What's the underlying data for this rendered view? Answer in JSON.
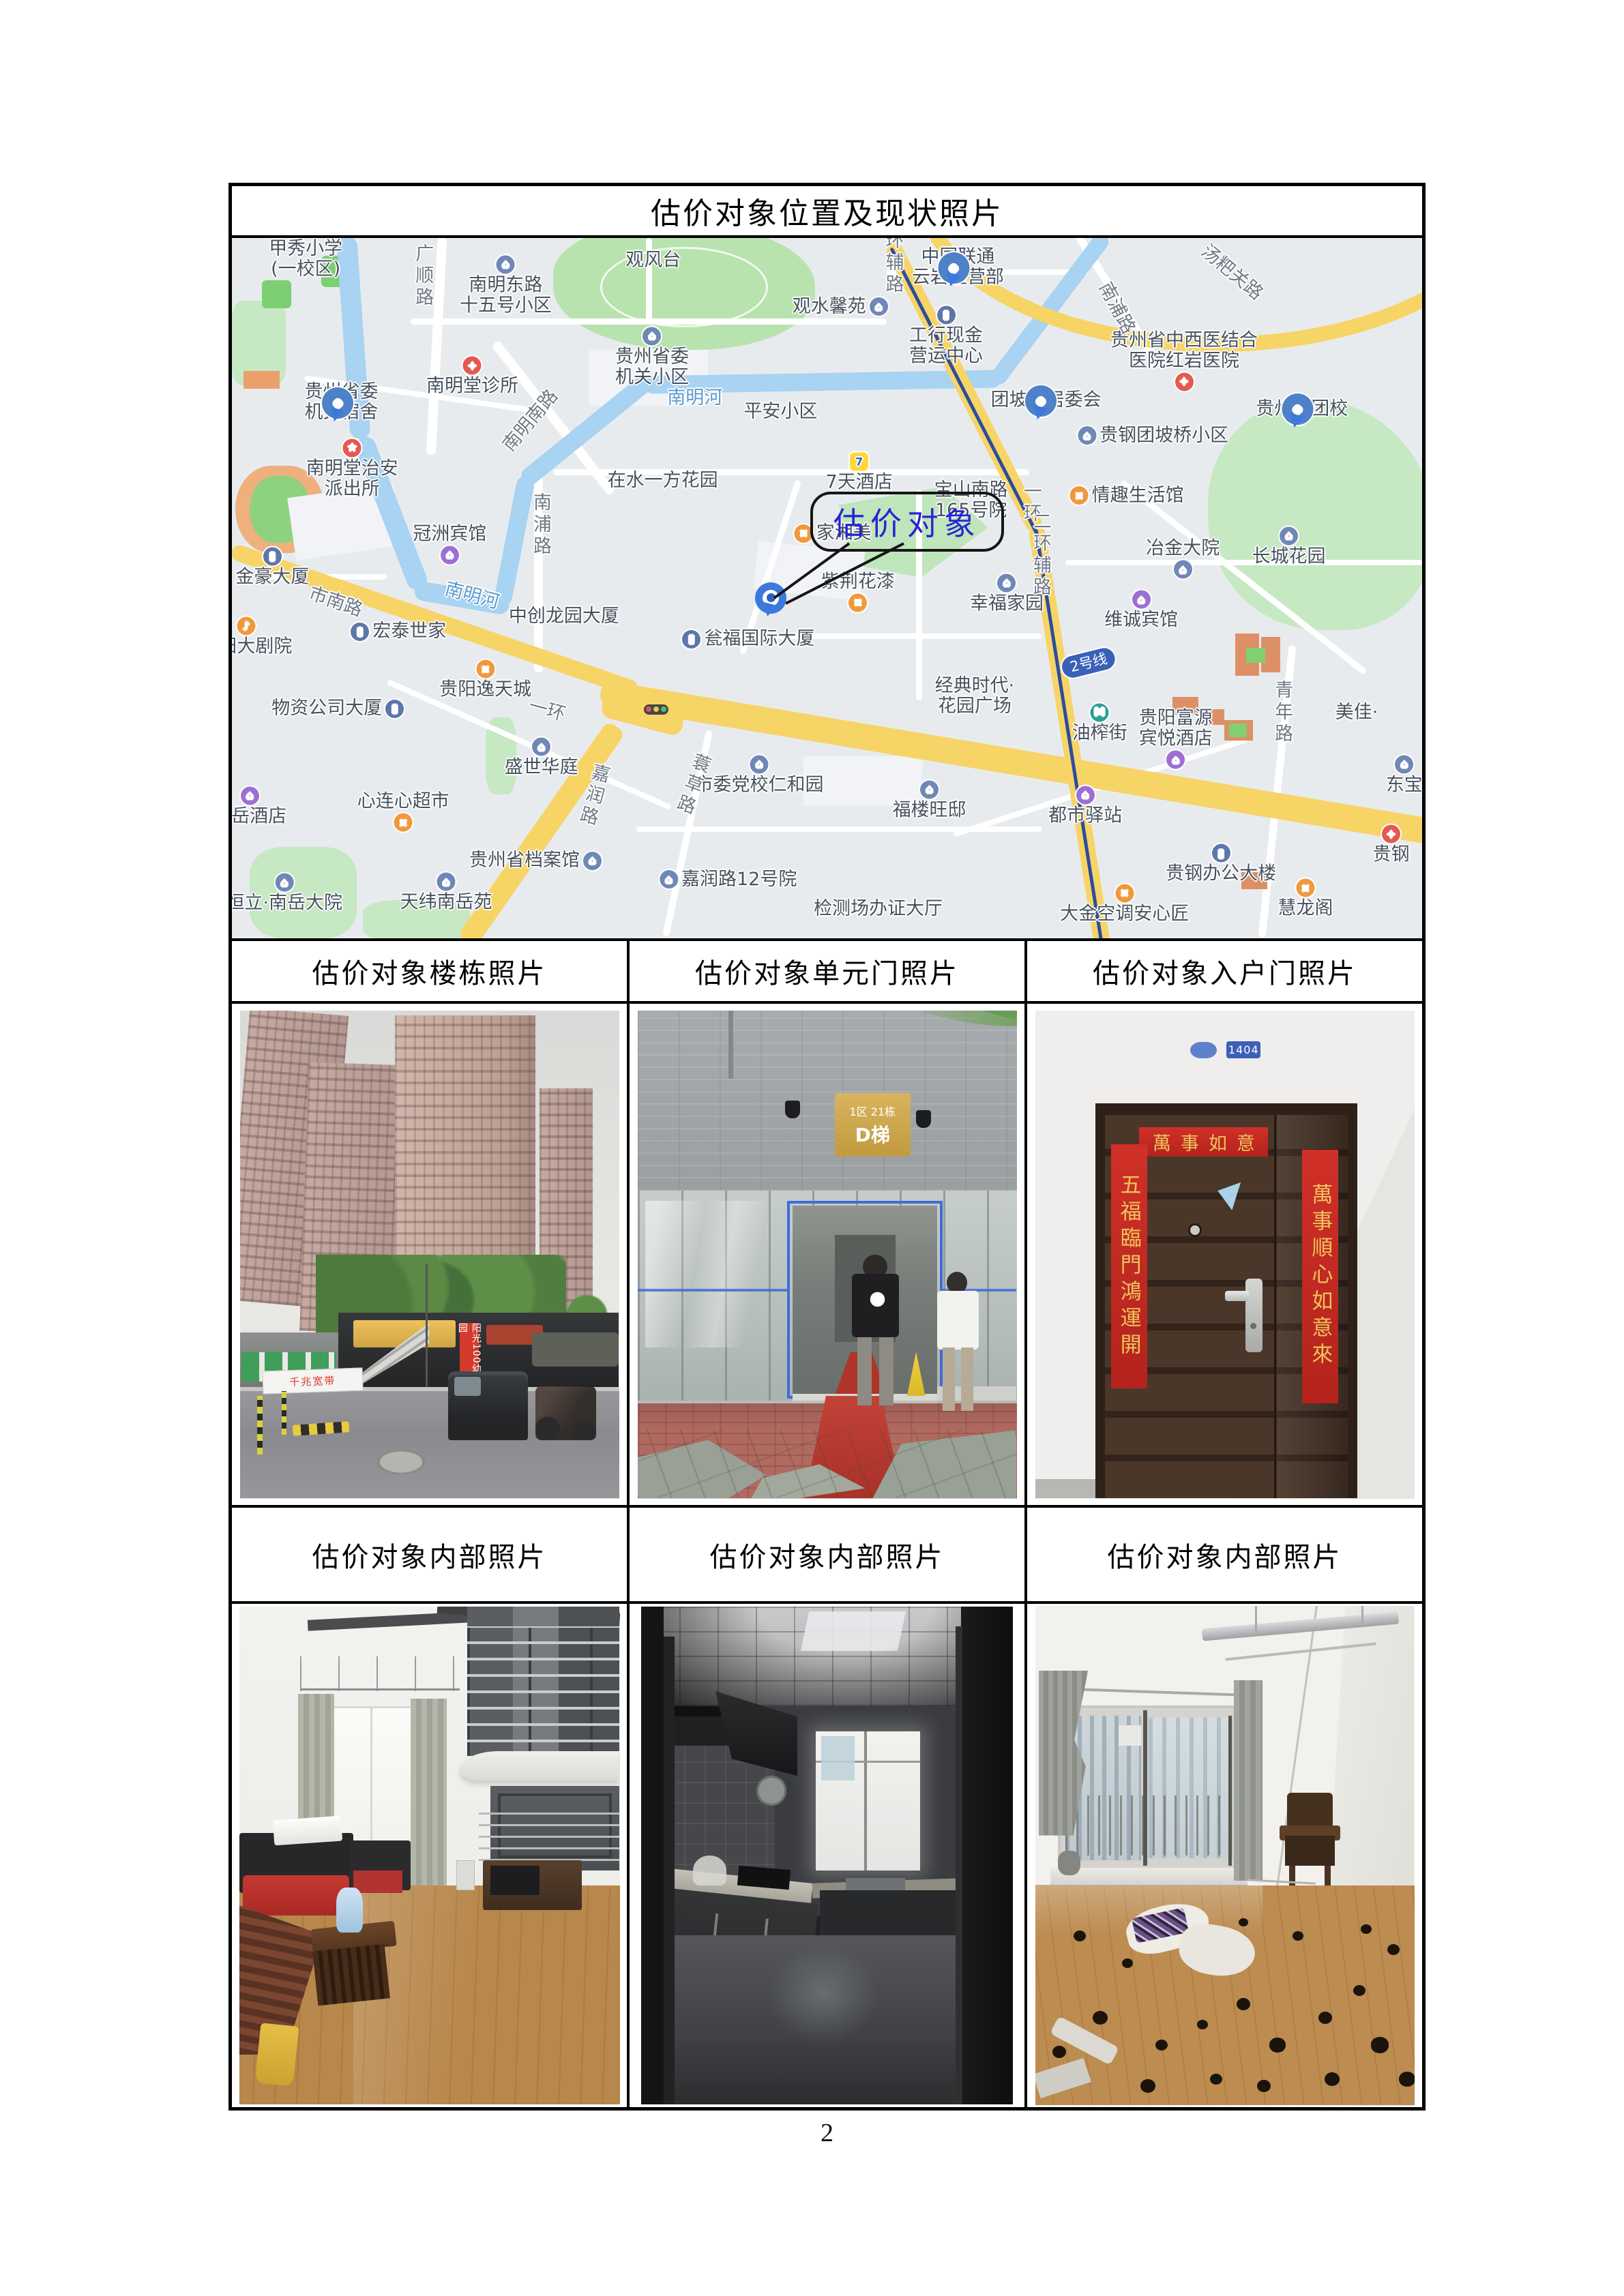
{
  "page": {
    "number": "2"
  },
  "table": {
    "title": "估价对象位置及现状照片",
    "row2_headers": [
      "估价对象楼栋照片",
      "估价对象单元门照片",
      "估价对象入户门照片"
    ],
    "row3_headers": [
      "估价对象内部照片",
      "估价对象内部照片",
      "估价对象内部照片"
    ]
  },
  "map": {
    "callout": {
      "label": "估价对象"
    },
    "labels": [
      {
        "t": "甲秀小学|(一校区)",
        "x": 6.2,
        "y": 3.0
      },
      {
        "t": "广顺路",
        "x": 16.0,
        "y": 5.5,
        "cls": "road",
        "vert": 1
      },
      {
        "t": "南明东路|十五号小区",
        "x": 23.0,
        "y": 6.8,
        "icon": "home",
        "ipos": "above"
      },
      {
        "t": "观风台",
        "x": 35.4,
        "y": 3.2
      },
      {
        "t": "观水馨苑",
        "x": 51.1,
        "y": 9.8,
        "icon": "home",
        "ipos": "right"
      },
      {
        "t": "中国联通|云岩经营部",
        "x": 61.0,
        "y": 4.2,
        "icon": "pin",
        "ipos": "left"
      },
      {
        "t": "工行现金|营运中心",
        "x": 60.0,
        "y": 14.0,
        "icon": "building",
        "ipos": "above"
      },
      {
        "t": "贵州省中西医结合|医院红岩医院",
        "x": 80.0,
        "y": 17.5,
        "icon": "hospital",
        "ipos": "below"
      },
      {
        "t": "汤粑关路",
        "x": 84.0,
        "y": 5.0,
        "cls": "road",
        "rot": 40
      },
      {
        "t": "南浦路",
        "x": 74.3,
        "y": 10.0,
        "cls": "road",
        "rot": 62
      },
      {
        "t": "贵州省委|机关宿舍",
        "x": 9.2,
        "y": 23.5,
        "icon": "pin",
        "ipos": "right"
      },
      {
        "t": "南明堂诊所",
        "x": 20.2,
        "y": 19.8,
        "icon": "hospital",
        "ipos": "above"
      },
      {
        "t": "贵州省委|机关小区",
        "x": 35.3,
        "y": 17.0,
        "icon": "home",
        "ipos": "above"
      },
      {
        "t": "南明堂治安|派出所",
        "x": 10.1,
        "y": 33.0,
        "icon": "police",
        "ipos": "above"
      },
      {
        "t": "南明南路",
        "x": 25.1,
        "y": 26.1,
        "cls": "road",
        "rot": -50
      },
      {
        "t": "南明河",
        "x": 38.9,
        "y": 22.9,
        "cls": "river"
      },
      {
        "t": "平安小区",
        "x": 46.1,
        "y": 24.8
      },
      {
        "t": "在水一方花园",
        "x": 36.2,
        "y": 34.7
      },
      {
        "t": "团坡桥居委会",
        "x": 68.4,
        "y": 23.2,
        "icon": "pin",
        "ipos": "right"
      },
      {
        "t": "贵钢团坡桥小区",
        "x": 77.4,
        "y": 28.2,
        "icon": "home",
        "ipos": "left"
      },
      {
        "t": "贵州省团校",
        "x": 89.9,
        "y": 24.4,
        "icon": "pin",
        "ipos": "above"
      },
      {
        "t": "情趣生活馆",
        "x": 75.2,
        "y": 36.8,
        "icon": "shop",
        "ipos": "left"
      },
      {
        "t": "7天酒店",
        "x": 52.7,
        "y": 33.5,
        "icon": "seven",
        "ipos": "above"
      },
      {
        "t": "宝山南路|165号院",
        "x": 62.1,
        "y": 37.5
      },
      {
        "t": "家湘美",
        "x": 50.5,
        "y": 42.2,
        "icon": "shop",
        "ipos": "left"
      },
      {
        "t": "紫荆花漆",
        "x": 52.6,
        "y": 50.5,
        "icon": "shop",
        "ipos": "below"
      },
      {
        "t": "幸福家园",
        "x": 65.1,
        "y": 50.8,
        "icon": "home",
        "ipos": "above"
      },
      {
        "t": "冠洲宾馆",
        "x": 18.3,
        "y": 43.7,
        "icon": "hotel",
        "ipos": "below"
      },
      {
        "t": "南浦路",
        "x": 25.9,
        "y": 41.0,
        "cls": "road",
        "vert": 1
      },
      {
        "t": "金豪大厦",
        "x": 3.4,
        "y": 47.0,
        "icon": "building",
        "ipos": "above"
      },
      {
        "t": "市南路",
        "x": 8.7,
        "y": 52.0,
        "cls": "road",
        "rot": 19
      },
      {
        "t": "贵阳大剧院",
        "x": 1.2,
        "y": 57.0,
        "icon": "music",
        "ipos": "above"
      },
      {
        "t": "宏泰世家",
        "x": 14.0,
        "y": 56.2,
        "icon": "building",
        "ipos": "left"
      },
      {
        "t": "南明河",
        "x": 20.2,
        "y": 51.1,
        "cls": "river",
        "rot": 15
      },
      {
        "t": "中创龙园大厦",
        "x": 27.9,
        "y": 54.0
      },
      {
        "t": "瓮福国际大厦",
        "x": 43.4,
        "y": 57.3,
        "icon": "building",
        "ipos": "left"
      },
      {
        "t": "贵阳逸天城",
        "x": 21.3,
        "y": 63.1,
        "icon": "shop",
        "ipos": "above"
      },
      {
        "t": "物资公司大厦",
        "x": 8.9,
        "y": 67.2,
        "icon": "building",
        "ipos": "right"
      },
      {
        "t": "经典时代·|花园广场",
        "x": 62.4,
        "y": 65.4
      },
      {
        "t": "油榨街",
        "x": 72.9,
        "y": 69.3,
        "icon": "metro",
        "ipos": "above"
      },
      {
        "t": "2号线",
        "x": 72.0,
        "y": 60.7,
        "cls": "badge2",
        "rot": -14
      },
      {
        "t": "贵阳富源|宾悦酒店",
        "x": 79.3,
        "y": 71.5,
        "icon": "hotel",
        "ipos": "below"
      },
      {
        "t": "都市驿站",
        "x": 71.7,
        "y": 81.1,
        "icon": "hotel",
        "ipos": "above"
      },
      {
        "t": "青年路",
        "x": 88.2,
        "y": 67.8,
        "cls": "road",
        "vert": 1
      },
      {
        "t": "美佳·",
        "x": 94.5,
        "y": 67.8
      },
      {
        "t": "东宝",
        "x": 98.5,
        "y": 76.7,
        "icon": "home",
        "ipos": "above"
      },
      {
        "t": "贵钢",
        "x": 97.4,
        "y": 86.7,
        "icon": "hospital",
        "ipos": "above"
      },
      {
        "t": "贵钢办公大楼",
        "x": 83.1,
        "y": 89.4,
        "icon": "building",
        "ipos": "above"
      },
      {
        "t": "大金空调安心匠",
        "x": 75.0,
        "y": 95.1,
        "icon": "shop",
        "ipos": "above"
      },
      {
        "t": "慧龙阁",
        "x": 90.2,
        "y": 94.4,
        "icon": "shop",
        "ipos": "above"
      },
      {
        "t": "长城花园",
        "x": 88.8,
        "y": 44.1,
        "icon": "home",
        "ipos": "above"
      },
      {
        "t": "冶金大院",
        "x": 79.9,
        "y": 45.8,
        "icon": "home",
        "ipos": "below"
      },
      {
        "t": "维诚宾馆",
        "x": 76.4,
        "y": 53.2,
        "icon": "hotel",
        "ipos": "above"
      },
      {
        "t": "一环",
        "x": 67.1,
        "y": 37.9,
        "cls": "road",
        "vert": 1
      },
      {
        "t": "二环辅路",
        "x": 67.9,
        "y": 45.3,
        "cls": "road",
        "vert": 1
      },
      {
        "t": "环辅路",
        "x": 55.5,
        "y": 3.6,
        "cls": "road",
        "vert": 1
      },
      {
        "t": "一环",
        "x": 26.5,
        "y": 67.5,
        "cls": "road",
        "rot": 15
      },
      {
        "t": "盛世华庭",
        "x": 26.0,
        "y": 74.2,
        "icon": "home",
        "ipos": "above"
      },
      {
        "t": "嘉润路",
        "x": 30.3,
        "y": 79.6,
        "cls": "road",
        "vert": 1,
        "rot": 15
      },
      {
        "t": "心连心超市",
        "x": 14.4,
        "y": 81.9,
        "icon": "cart",
        "ipos": "below"
      },
      {
        "t": "南岳酒店",
        "x": 1.5,
        "y": 81.2,
        "icon": "hotel",
        "ipos": "above"
      },
      {
        "t": "贵州省档案馆",
        "x": 25.5,
        "y": 88.9,
        "icon": "home",
        "ipos": "right"
      },
      {
        "t": "恒立·南岳大院",
        "x": 4.4,
        "y": 93.6,
        "icon": "home",
        "ipos": "above"
      },
      {
        "t": "天纬南岳苑",
        "x": 18.0,
        "y": 93.5,
        "icon": "home",
        "ipos": "above"
      },
      {
        "t": "市委党校仁和园",
        "x": 44.3,
        "y": 76.7,
        "icon": "home",
        "ipos": "above"
      },
      {
        "t": "蓑草路",
        "x": 38.6,
        "y": 78.0,
        "cls": "road",
        "vert": 1,
        "rot": 20
      },
      {
        "t": "嘉润路12号院",
        "x": 41.7,
        "y": 91.6,
        "icon": "home",
        "ipos": "left"
      },
      {
        "t": "福楼旺邸",
        "x": 58.6,
        "y": 80.3,
        "icon": "home",
        "ipos": "above"
      },
      {
        "t": "检测场办证大厅",
        "x": 54.3,
        "y": 95.8
      }
    ]
  },
  "photos": {
    "building": {
      "banner_small": "千兆宽带",
      "banner_vertical": "阳光100幼儿园"
    },
    "unit_door": {
      "sign_line1": "1区 21栋",
      "sign_line2": "D梯"
    },
    "entry_door": {
      "plate": "1404",
      "couplet_top": "萬事如意",
      "couplet_left": "五福臨門鴻運開",
      "couplet_right": "萬事順心如意來"
    }
  }
}
